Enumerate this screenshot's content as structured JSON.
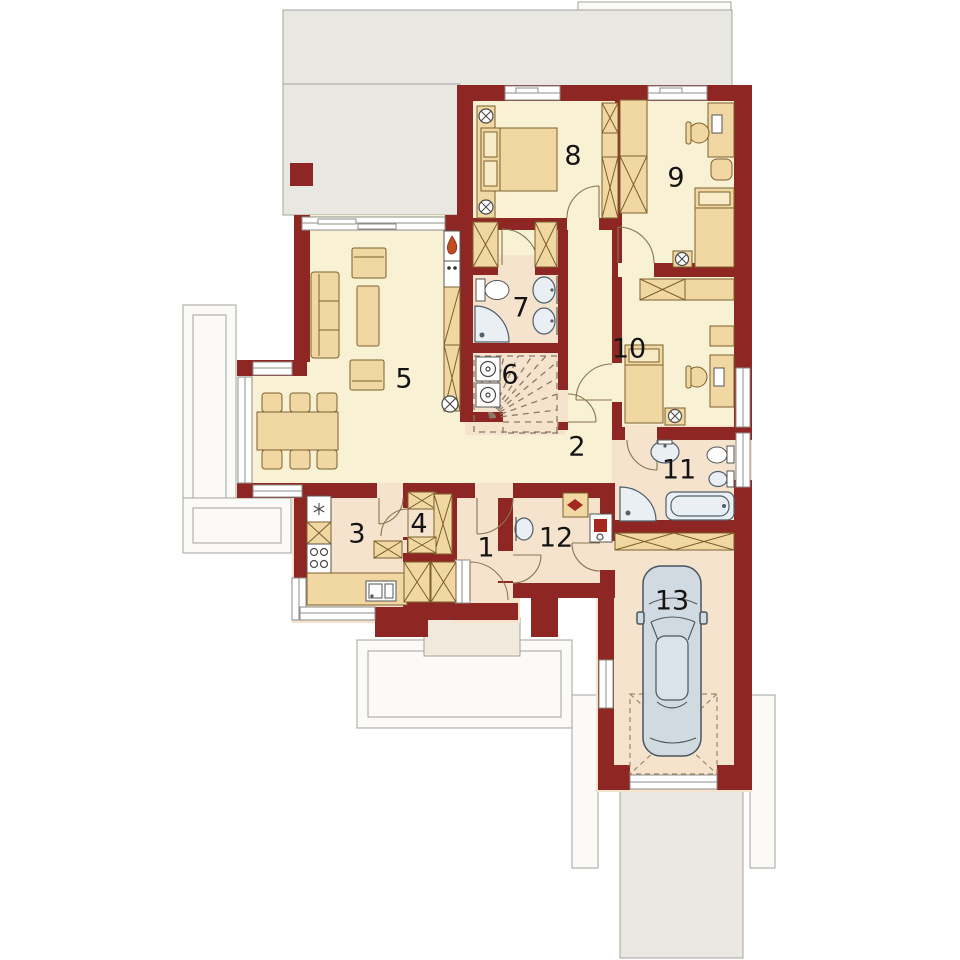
{
  "plan": {
    "rooms": [
      {
        "number": "1"
      },
      {
        "number": "2"
      },
      {
        "number": "3"
      },
      {
        "number": "4"
      },
      {
        "number": "5"
      },
      {
        "number": "6"
      },
      {
        "number": "7"
      },
      {
        "number": "8"
      },
      {
        "number": "9"
      },
      {
        "number": "10"
      },
      {
        "number": "11"
      },
      {
        "number": "12"
      },
      {
        "number": "13"
      }
    ]
  },
  "colors": {
    "wall": "#8e2723",
    "floor_main": "#f8f1d4",
    "floor_service": "#f5e3cd",
    "terrace": "#e9e7e2",
    "furniture": "#f1d8a3",
    "furniture_light": "#f8ebc8",
    "fixture": "#e9eff3",
    "car": "#d2dae1",
    "accent_red": "#a5281f",
    "accent_flame": "#bf4e1f"
  }
}
